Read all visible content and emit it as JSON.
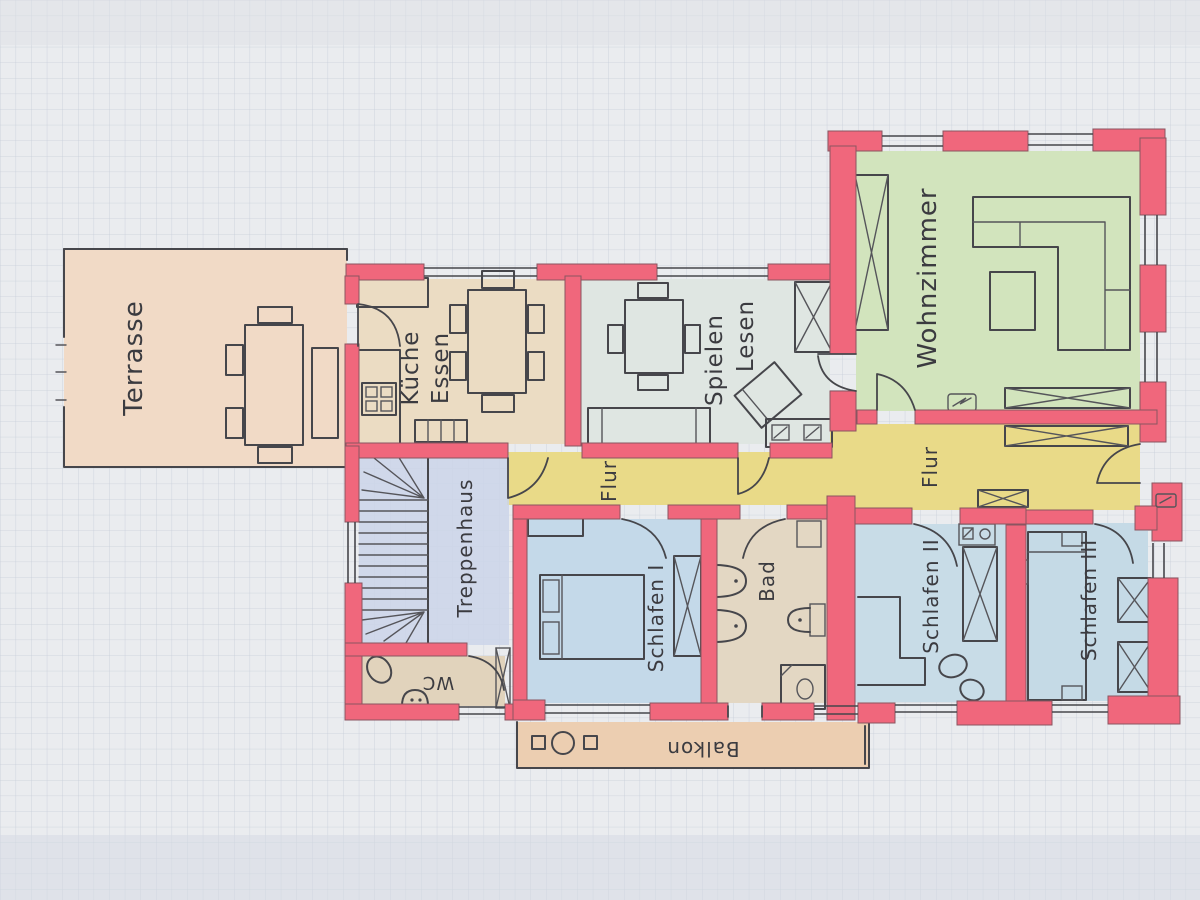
{
  "rooms": {
    "terrasse": {
      "label": "Terrasse",
      "color": "#f1dac6"
    },
    "kueche": {
      "label": "Küche",
      "label2": "Essen",
      "color": "#ebdcc3"
    },
    "spielen_lesen": {
      "label": "Spielen",
      "label2": "Lesen",
      "color": "#dfe6e2"
    },
    "wohnzimmer": {
      "label": "Wohnzimmer",
      "color": "#d2e4bd"
    },
    "flur_links": {
      "label": "Flur",
      "color": "#e9da88"
    },
    "flur_rechts": {
      "label": "Flur",
      "color": "#e9da88"
    },
    "treppenhaus": {
      "label": "Treppenhaus",
      "color": "#cbd5e9"
    },
    "schlafen_1": {
      "label": "Schlafen I",
      "color": "#c4d9e9"
    },
    "bad": {
      "label": "Bad",
      "color": "#e3d7c3"
    },
    "schlafen_2": {
      "label": "Schlafen II",
      "color": "#c8dce7"
    },
    "schlafen_3": {
      "label": "Schlafen III",
      "color": "#c5dae6"
    },
    "wc": {
      "label": "WC",
      "color": "#e1d3bc"
    },
    "balkon": {
      "label": "Balkon",
      "color": "#ecceb1"
    }
  },
  "colors": {
    "wall": "#f0677c",
    "paper": "#eaecef",
    "grid": "#c7ced9",
    "pencil": "#3f3f44",
    "flur": "#e9da88"
  }
}
